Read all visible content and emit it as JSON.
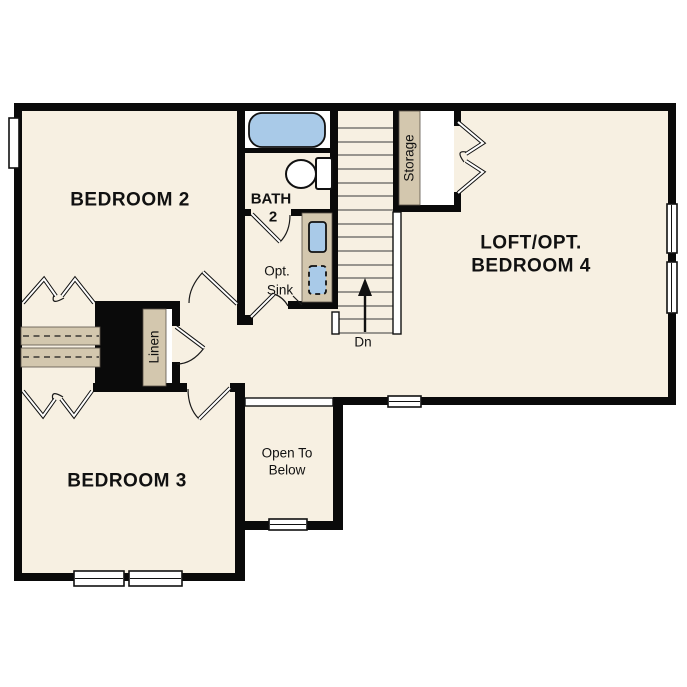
{
  "palette": {
    "floor_beige": "#f7f0e2",
    "wall_black": "#0a0a0a",
    "fixture_tan": "#d3c7ae",
    "water_blue": "#a9cae8",
    "white": "#ffffff",
    "line_black": "#111111"
  },
  "labels": {
    "bedroom2": "BEDROOM 2",
    "bath_line1": "BATH",
    "bath_line2": "2",
    "opt_sink_line1": "Opt.",
    "opt_sink_line2": "Sink",
    "storage": "Storage",
    "loft_line1": "LOFT/OPT.",
    "loft_line2": "BEDROOM 4",
    "stairs_dn": "Dn",
    "linen": "Linen",
    "bedroom3": "BEDROOM 3",
    "open_below_line1": "Open To",
    "open_below_line2": "Below"
  }
}
